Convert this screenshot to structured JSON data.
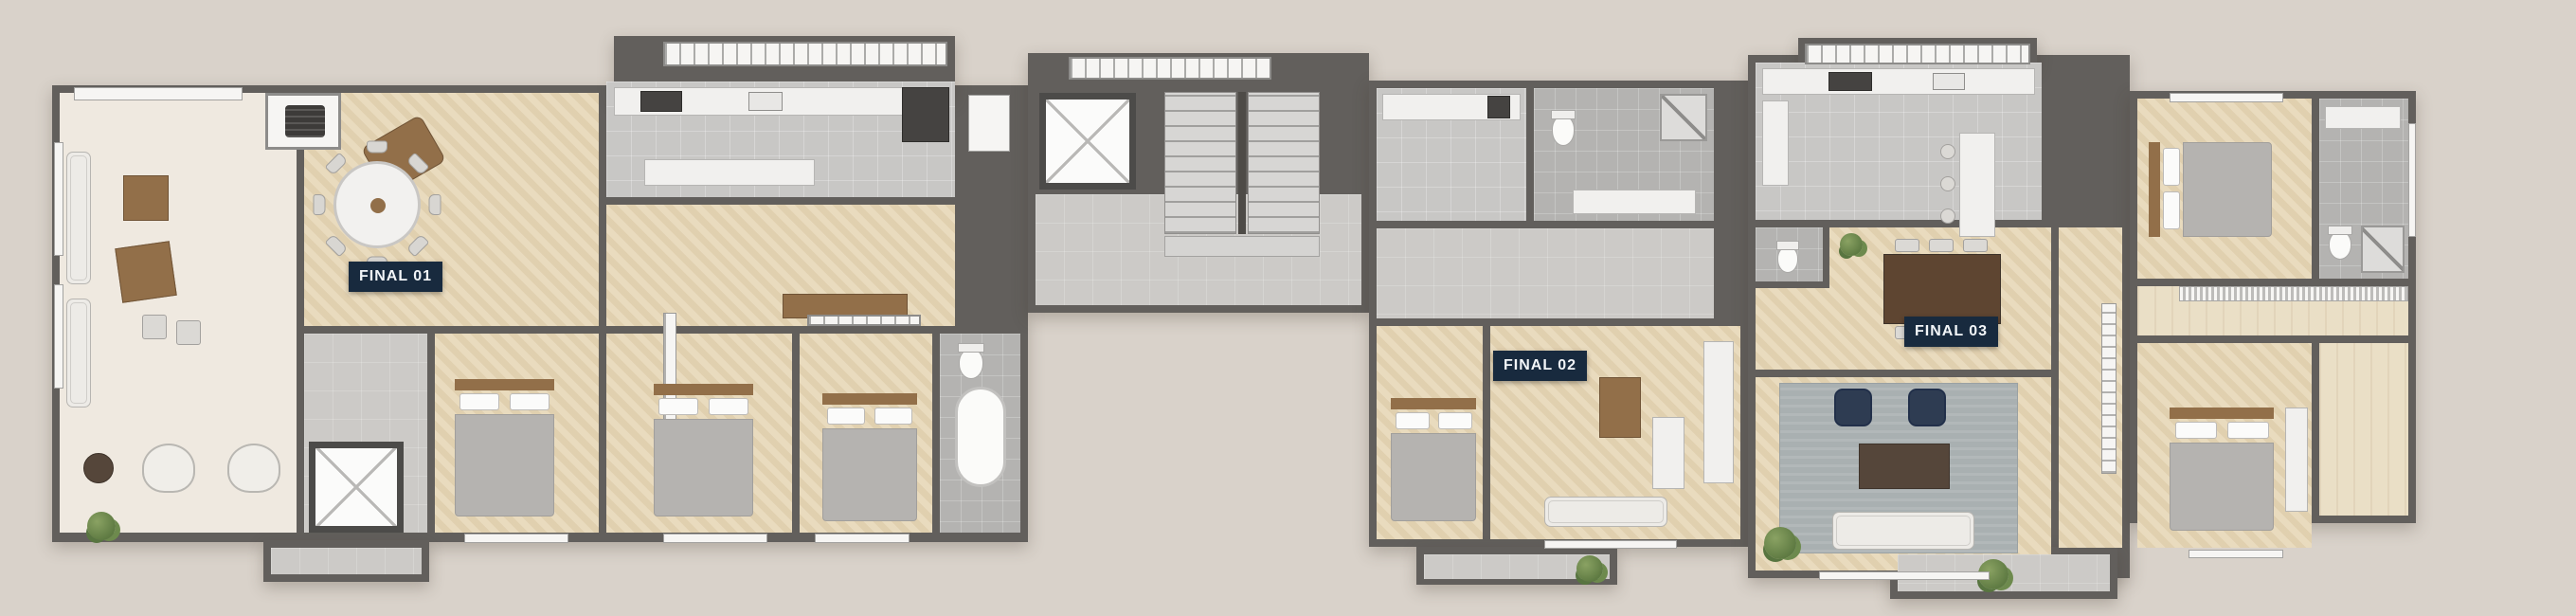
{
  "units": [
    {
      "id": "final-01",
      "label": "FINAL 01"
    },
    {
      "id": "final-02",
      "label": "FINAL 02"
    },
    {
      "id": "final-03",
      "label": "FINAL 03"
    }
  ],
  "palette": {
    "bg": "#d9d2ca",
    "wall": "#625f5c",
    "wood": "#e7d7b7",
    "wood2": "#eadfc6",
    "cream": "#efe9e0",
    "tile": "#c8c7c5",
    "tiled": "#b4b3b1",
    "gray": "#cccac7",
    "white": "#f6f5f3",
    "counter": "#f1f0ee",
    "labelbg": "#182a3e",
    "labelfg": "#f2f5f8",
    "brown": "#926f49",
    "browndark": "#6b4f35",
    "navy": "#2e3c52",
    "rug": "#a9b0b1",
    "bedc": "#c3c1be",
    "duvet": "#b5b3b0",
    "green": "#6e8550",
    "dark": "#4e4b47"
  },
  "icons": [
    "elevator-cross-icon",
    "stairs-icon",
    "barbecue-grill-icon",
    "plant-icon",
    "toilet-icon",
    "bathtub-icon",
    "shower-icon",
    "cooktop-icon",
    "sink-icon"
  ]
}
